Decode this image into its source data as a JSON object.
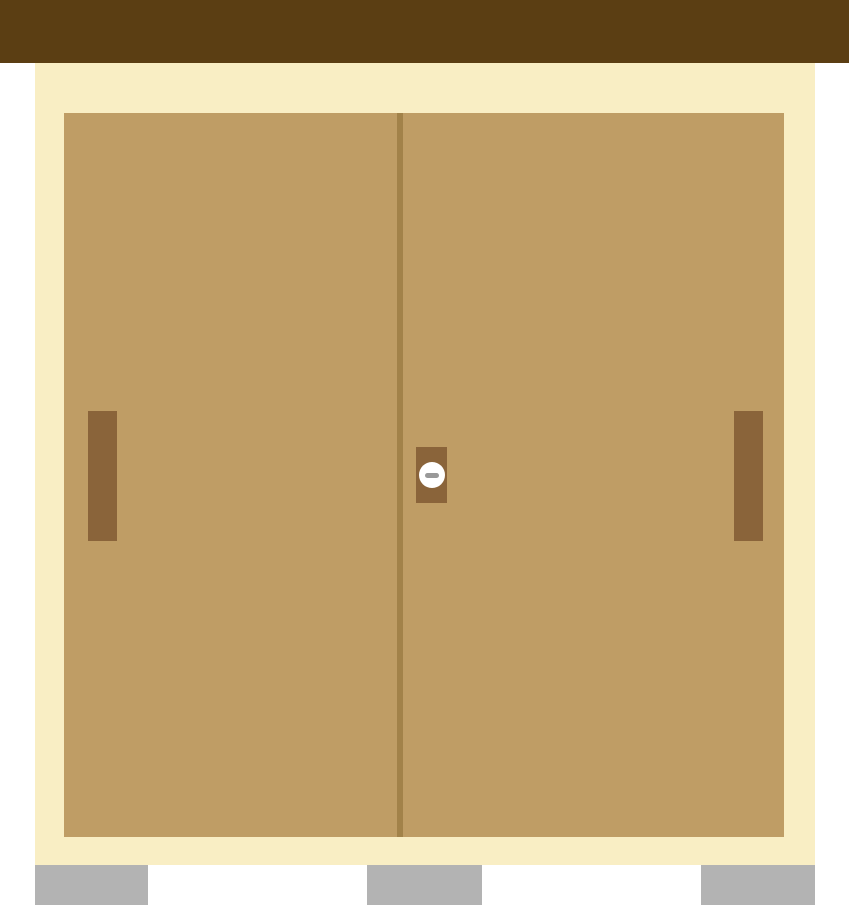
{
  "scene": {
    "description": "Flat illustration of a Japanese-style closet with two sliding doors",
    "objects": {
      "roof_beam": "roof-beam",
      "wall": "wall-frame",
      "door_left": "left-sliding-door",
      "door_right": "right-sliding-door",
      "door_divider": "door-seam",
      "handle_left": "left-door-pull",
      "handle_right": "right-door-pull",
      "lock": "thumb-turn-lock",
      "feet": [
        "foot-left",
        "foot-center",
        "foot-right"
      ]
    }
  },
  "colors": {
    "background": "#FFFFFF",
    "roof_beam": "#5B3E13",
    "wall": "#F9EEC4",
    "door": "#BF9D65",
    "door_divider": "#A28249",
    "handle": "#8A643A",
    "lock_plate": "#8A643A",
    "lock_dial_face": "#FFFFFF",
    "lock_dial_slot": "#999999",
    "foot": "#B3B3B3"
  }
}
